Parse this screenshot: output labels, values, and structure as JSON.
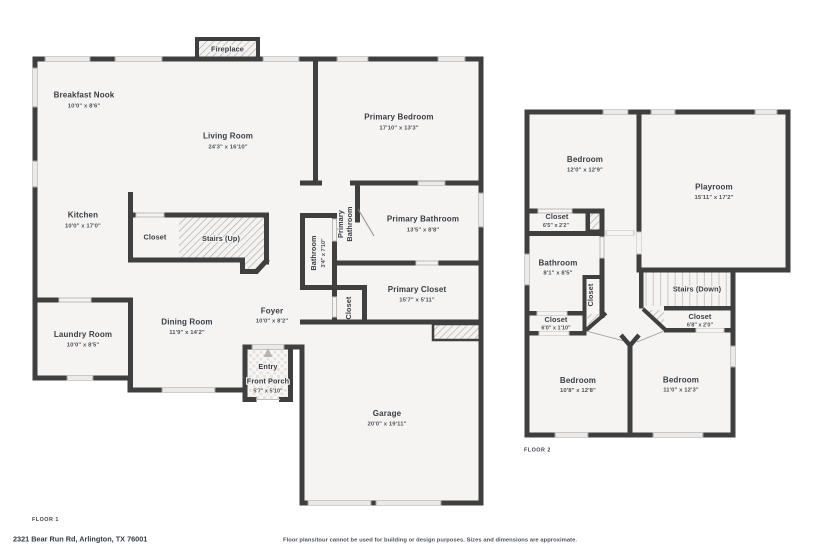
{
  "meta": {
    "floor1_label": "FLOOR 1",
    "floor2_label": "FLOOR 2",
    "address": "2321 Bear Run Rd, Arlington, TX 76001",
    "disclaimer": "Floor plans/tour cannot be used for building or design purposes. Sizes and dimensions are approximate."
  },
  "colors": {
    "wall": "#3f3f3f",
    "floor_fill": "#f5f4f2",
    "window_fill": "#ebeae8",
    "hatch_line": "#ababab",
    "text": "#383d45"
  },
  "floor1": {
    "fireplace": {
      "name": "Fireplace"
    },
    "breakfast_nook": {
      "name": "Breakfast Nook",
      "dims": "10'0\" x 8'6\""
    },
    "living_room": {
      "name": "Living Room",
      "dims": "24'3\" x 16'10\""
    },
    "primary_bedroom": {
      "name": "Primary Bedroom",
      "dims": "17'10\" x 13'3\""
    },
    "kitchen": {
      "name": "Kitchen",
      "dims": "10'0\" x 17'0\""
    },
    "closet": {
      "name": "Closet"
    },
    "stairs_up": {
      "name": "Stairs (Up)"
    },
    "bathroom": {
      "name": "Bathroom",
      "dims": "3'4\" x 7'10\""
    },
    "primary_bathroom_hall": {
      "line1": "Primary",
      "line2": "Bathroom"
    },
    "primary_bathroom": {
      "name": "Primary Bathroom",
      "dims": "13'5\" x 8'8\""
    },
    "primary_closet": {
      "name": "Primary Closet",
      "dims": "15'7\" x 5'11\""
    },
    "foyer_closet": {
      "name": "Closet"
    },
    "foyer": {
      "name": "Foyer",
      "dims": "10'0\" x 8'2\""
    },
    "laundry_room": {
      "name": "Laundry Room",
      "dims": "10'0\" x 8'5\""
    },
    "dining_room": {
      "name": "Dining Room",
      "dims": "11'9\" x 14'2\""
    },
    "entry": {
      "name": "Entry"
    },
    "front_porch": {
      "name": "Front Porch",
      "dims": "5'7\" x 5'10\""
    },
    "garage": {
      "name": "Garage",
      "dims": "20'0\" x 19'11\""
    }
  },
  "floor2": {
    "bedroom_top": {
      "name": "Bedroom",
      "dims": "12'0\" x 12'9\""
    },
    "playroom": {
      "name": "Playroom",
      "dims": "15'11\" x 17'2\""
    },
    "closet_chimney": {
      "name": "Closet",
      "dims": "6'5\" x 2'2\""
    },
    "bathroom": {
      "name": "Bathroom",
      "dims": "8'1\" x 8'5\""
    },
    "closet_hall": {
      "name": "Closet"
    },
    "stairs_down": {
      "name": "Stairs (Down)"
    },
    "closet_left": {
      "name": "Closet",
      "dims": "6'0\" x 1'10\""
    },
    "closet_right": {
      "name": "Closet",
      "dims": "6'8\" x 2'0\""
    },
    "bedroom_left": {
      "name": "Bedroom",
      "dims": "10'8\" x 12'8\""
    },
    "bedroom_right": {
      "name": "Bedroom",
      "dims": "11'0\" x 12'3\""
    }
  }
}
